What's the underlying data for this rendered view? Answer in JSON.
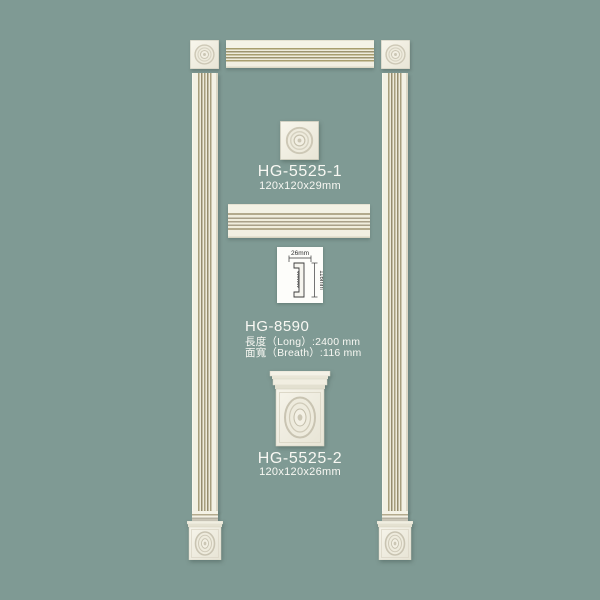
{
  "page": {
    "description": "PU moulding product catalog image: door/window frame assembly with fluted pilaster mouldings, corner rosette blocks and plinth blocks",
    "background_color": "#7f9a94",
    "moulding_color": "#f3f1e4",
    "flute_line_color": "#a89e72",
    "text_color": "#f8f8f3"
  },
  "products": {
    "corner_block": {
      "code": "HG-5525-1",
      "size": "120x120x29mm"
    },
    "moulding": {
      "code": "HG-8590",
      "length": "長度（Long）:2400 mm",
      "breadth": "面寬（Breath）:116 mm",
      "diagram": {
        "width_label": "26mm",
        "height_label": "116mm"
      }
    },
    "plinth_block": {
      "code": "HG-5525-2",
      "size": "120x120x26mm"
    }
  }
}
